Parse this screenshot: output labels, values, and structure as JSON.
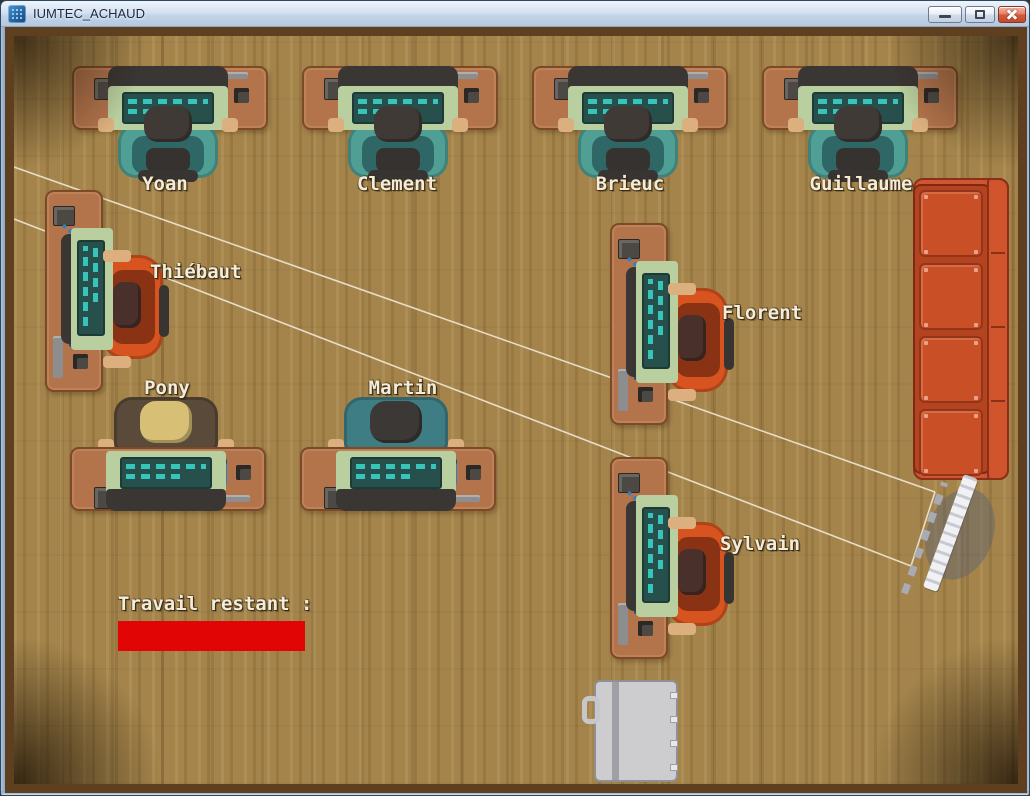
{
  "window": {
    "title": "IUMTEC_ACHAUD",
    "controls": [
      {
        "id": "minimize",
        "icon": "minimize-icon"
      },
      {
        "id": "maximize",
        "icon": "maximize-icon"
      },
      {
        "id": "close",
        "icon": "close-icon"
      }
    ]
  },
  "hud": {
    "work_label": "Travail restant :",
    "work_bar": {
      "x": 104,
      "y": 585,
      "w": 187,
      "h": 30,
      "fill_ratio": 1,
      "color": "#e10505"
    }
  },
  "workstations": [
    {
      "id": "yoan",
      "name": "Yoan",
      "orientation": "n",
      "hair": "#403a36",
      "chair": "#4f9f95",
      "x": 58,
      "y": 30,
      "label": {
        "x": 151,
        "y": 148,
        "align": "center"
      }
    },
    {
      "id": "clement",
      "name": "Clement",
      "orientation": "n",
      "hair": "#403a36",
      "chair": "#4f9f95",
      "x": 288,
      "y": 30,
      "label": {
        "x": 383,
        "y": 148,
        "align": "center"
      }
    },
    {
      "id": "brieuc",
      "name": "Brieuc",
      "orientation": "n",
      "hair": "#403a36",
      "chair": "#4f9f95",
      "x": 518,
      "y": 30,
      "label": {
        "x": 616,
        "y": 148,
        "align": "center"
      }
    },
    {
      "id": "guillaume",
      "name": "Guillaume",
      "orientation": "n",
      "hair": "#403a36",
      "chair": "#4f9f95",
      "x": 748,
      "y": 30,
      "label": {
        "x": 847,
        "y": 148,
        "align": "center"
      }
    },
    {
      "id": "thiebaut",
      "name": "Thiébaut",
      "orientation": "w",
      "hair": "#4a302a",
      "chair": "#d7531f",
      "x": 31,
      "y": 154,
      "label": {
        "x": 136,
        "y": 236,
        "align": "left"
      }
    },
    {
      "id": "pony",
      "name": "Pony",
      "orientation": "s",
      "hair": "#d8bf76",
      "chair": "#5a4a3a",
      "x": 56,
      "y": 359,
      "label": {
        "x": 153,
        "y": 352,
        "align": "center"
      }
    },
    {
      "id": "martin",
      "name": "Martin",
      "orientation": "s",
      "hair": "#3c3835",
      "chair": "#3f7d84",
      "x": 286,
      "y": 359,
      "label": {
        "x": 389,
        "y": 352,
        "align": "center"
      }
    },
    {
      "id": "florent",
      "name": "Florent",
      "orientation": "w",
      "hair": "#4a302a",
      "chair": "#d7531f",
      "x": 596,
      "y": 187,
      "label": {
        "x": 708,
        "y": 277,
        "align": "left"
      }
    },
    {
      "id": "sylvain",
      "name": "Sylvain",
      "orientation": "w",
      "hair": "#4a302a",
      "chair": "#d7531f",
      "x": 596,
      "y": 421,
      "label": {
        "x": 706,
        "y": 508,
        "align": "left"
      }
    }
  ],
  "objects": [
    {
      "id": "couch",
      "icon": "couch",
      "x": 899,
      "y": 142
    },
    {
      "id": "door",
      "icon": "door",
      "x": 580,
      "y": 644
    },
    {
      "id": "projector-screen",
      "icon": "projector-screen",
      "x": 879,
      "y": 435
    }
  ],
  "beams": {
    "color": "rgba(243,236,220,0.85)",
    "lines": [
      [
        0,
        131,
        921,
        456
      ],
      [
        0,
        183,
        897,
        530
      ],
      [
        921,
        456,
        897,
        530
      ]
    ]
  },
  "colors": {
    "floor": "#a9894f",
    "wall": "#5e3f20",
    "desk": "#b3744c",
    "couch": "#c95026",
    "titlebar": "#c9d9ec"
  }
}
